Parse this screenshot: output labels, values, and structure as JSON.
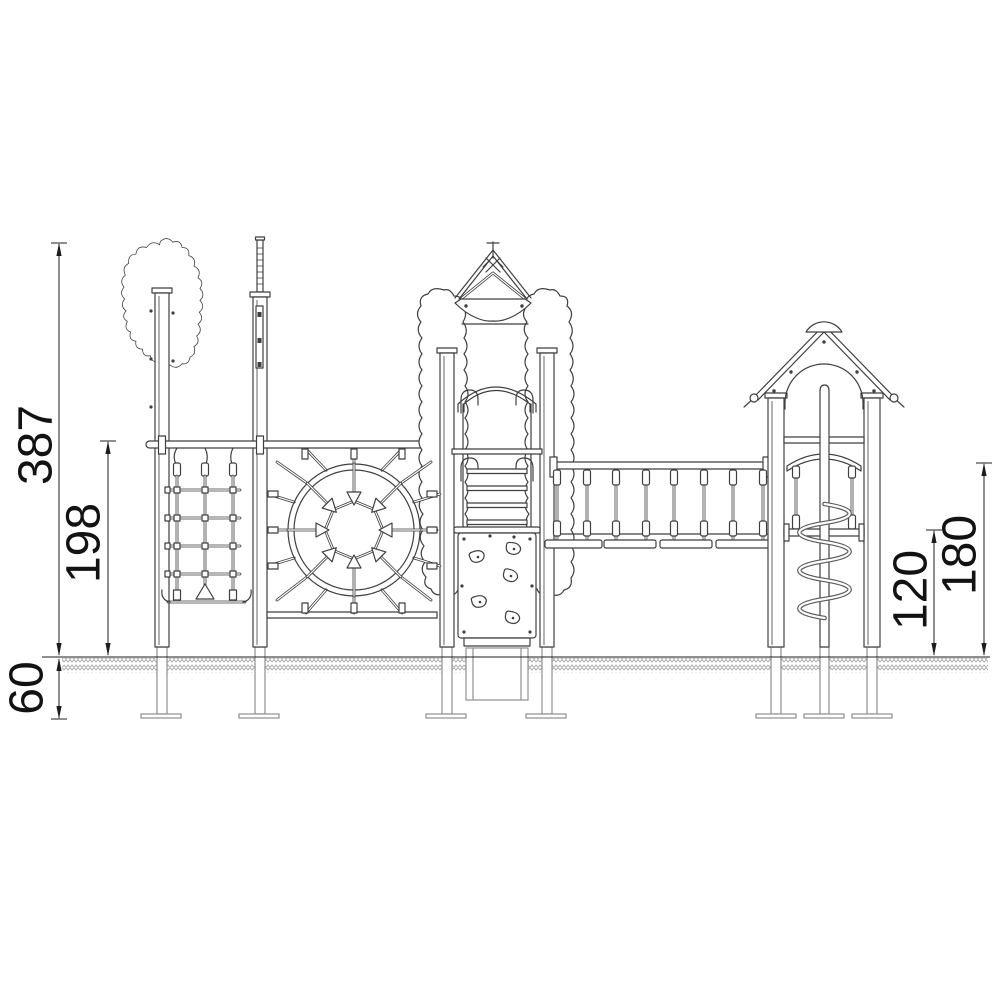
{
  "drawing": {
    "kind": "playground equipment front elevation",
    "line_color": "#3f3f3f",
    "dimension_color": "#1c1c1c",
    "underground_color": "#8f8f8f",
    "hatch_color": "#a6a6a6",
    "background": "#ffffff"
  },
  "dimensions": {
    "total_height": "387",
    "left_bar_height": "198",
    "foundation_depth": "60",
    "right_deck_height": "120",
    "right_rail_height": "180"
  }
}
